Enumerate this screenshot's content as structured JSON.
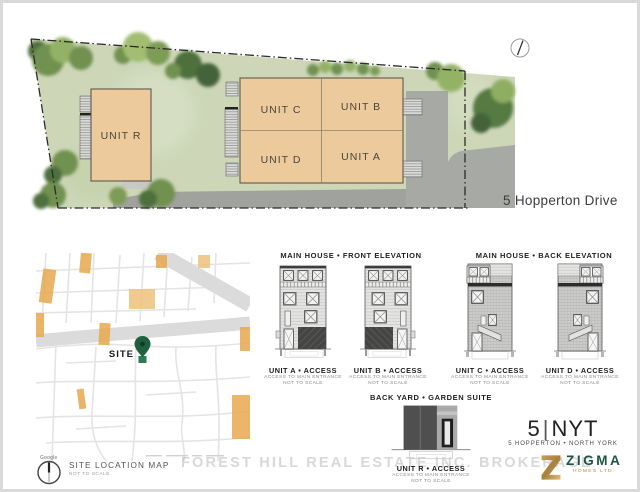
{
  "site_plan": {
    "street_label": "5 Hopperton Drive",
    "units": {
      "r": "UNIT R",
      "c": "UNIT C",
      "b": "UNIT B",
      "d": "UNIT D",
      "a": "UNIT A"
    }
  },
  "location_map": {
    "site_label": "SITE",
    "provider": "Google",
    "title": "SITE LOCATION MAP",
    "subtitle": "NOT TO SCALE"
  },
  "sections": {
    "front_title": "MAIN HOUSE • FRONT ELEVATION",
    "back_title": "MAIN HOUSE • BACK ELEVATION",
    "garden_title": "BACK YARD • GARDEN SUITE"
  },
  "access_captions": [
    {
      "title": "UNIT A • ACCESS",
      "line1": "ACCESS TO MAIN ENTRANCE",
      "line2": "NOT TO SCALE"
    },
    {
      "title": "UNIT B • ACCESS",
      "line1": "ACCESS TO MAIN ENTRANCE",
      "line2": "NOT TO SCALE"
    },
    {
      "title": "UNIT C • ACCESS",
      "line1": "ACCESS TO MAIN ENTRANCE",
      "line2": "NOT TO SCALE"
    },
    {
      "title": "UNIT D • ACCESS",
      "line1": "ACCESS TO MAIN ENTRANCE",
      "line2": "NOT TO SCALE"
    },
    {
      "title": "UNIT R • ACCESS",
      "line1": "ACCESS TO MAIN ENTRANCE",
      "line2": "NOT TO SCALE"
    }
  ],
  "branding": {
    "project_number": "5",
    "project_code_suffix": "NYT",
    "project_location": "5 HOPPERTON • NORTH YORK",
    "logo_name": "ZIGMA",
    "logo_subtitle": "HOMES LTD."
  },
  "watermark": "FOREST HILL REAL ESTATE INC. BROKERAGE",
  "colors": {
    "building_fill": "#ecca9b",
    "grass": "#cdd7b8",
    "road": "#a6a9a4",
    "map_accent": "#e8a94f",
    "pin_green": "#20603f",
    "logo_green": "#19573f",
    "logo_gold": "#bd9147"
  }
}
